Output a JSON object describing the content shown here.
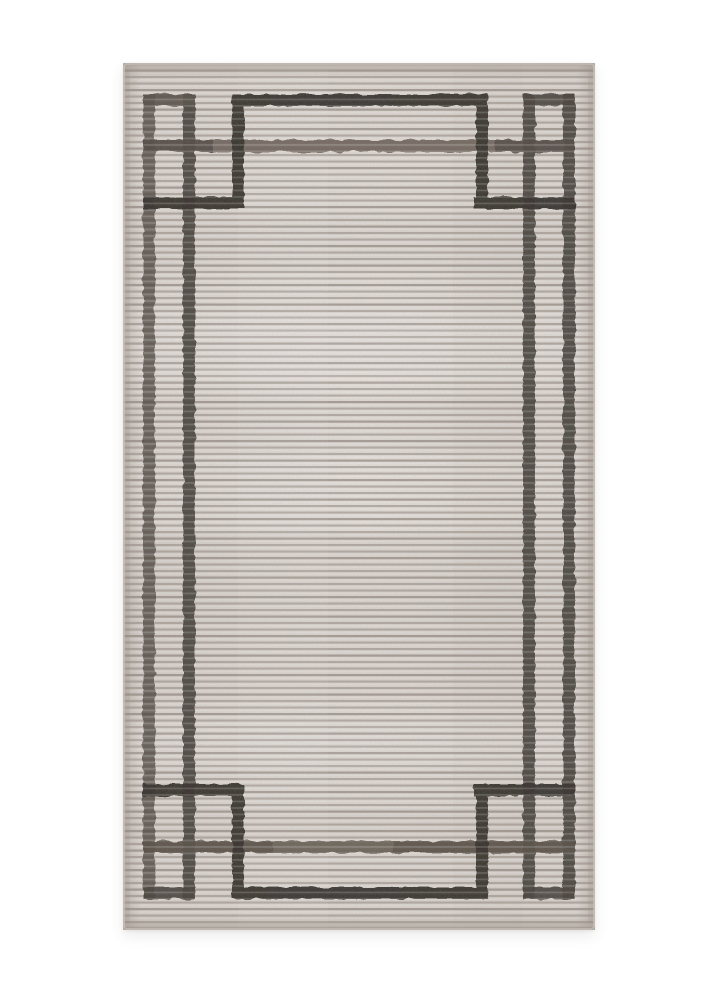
{
  "page": {
    "background": "#ffffff",
    "width": 719,
    "height": 1000
  },
  "photo": {
    "subject": "gray ribbed area rug, portrait orientation, with dark charcoal geometric double-frame border, stepped inner frame and corner squares, on white studio background",
    "rug": {
      "left": 123,
      "top": 63,
      "width": 472,
      "height": 867
    },
    "colors": {
      "page_background": "#ffffff",
      "field": "#d5cec9",
      "field_light": "#e5e0db",
      "rib": "#988e87",
      "rib_dark": "#887e77",
      "band": "#9b9087",
      "edge": "#93897f",
      "selvedge": "#c9c1bb",
      "border_dark": "#37322e",
      "border_mid": "#49433d",
      "border_mid2": "#585049",
      "border_faded": "#6f665d",
      "shadow": "rgba(60,55,50,0.10)"
    }
  }
}
